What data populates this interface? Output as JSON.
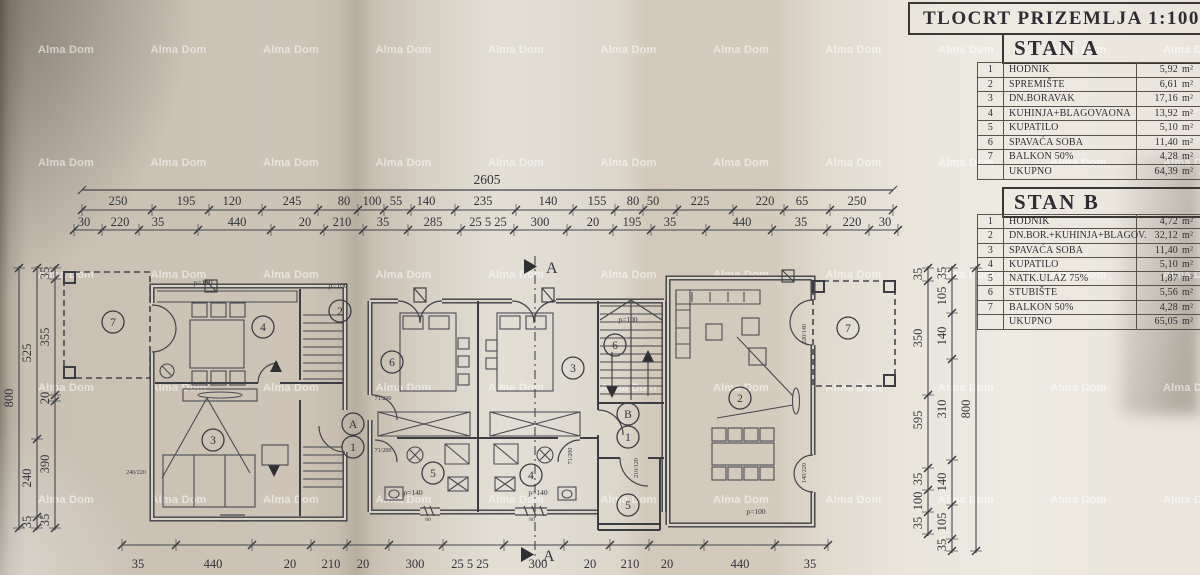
{
  "title_block": {
    "title": "TLOCRT  PRIZEMLJA 1:100"
  },
  "watermark": {
    "text": "Alma Dom"
  },
  "tables": {
    "stanA": {
      "header": "STAN A",
      "unit": "m²",
      "rows": [
        {
          "num": "1",
          "name": "HODNIK",
          "value": "5,92"
        },
        {
          "num": "2",
          "name": "SPREMIŠTE",
          "value": "6,61"
        },
        {
          "num": "3",
          "name": "DN.BORAVAK",
          "value": "17,16"
        },
        {
          "num": "4",
          "name": "KUHINJA+BLAGOVAONA",
          "value": "13,92"
        },
        {
          "num": "5",
          "name": "KUPATILO",
          "value": "5,10"
        },
        {
          "num": "6",
          "name": "SPAVAĆA SOBA",
          "value": "11,40"
        },
        {
          "num": "7",
          "name": "BALKON 50%",
          "value": "4,28"
        }
      ],
      "total": {
        "label": "UKUPNO",
        "value": "64,39"
      }
    },
    "stanB": {
      "header": "STAN B",
      "unit": "m²",
      "rows": [
        {
          "num": "1",
          "name": "HODNIK",
          "value": "4,72"
        },
        {
          "num": "2",
          "name": "DN.BOR.+KUHINJA+BLAGOV.",
          "value": "32,12"
        },
        {
          "num": "3",
          "name": "SPAVAĆA SOBA",
          "value": "11,40"
        },
        {
          "num": "4",
          "name": "KUPATILO",
          "value": "5,10"
        },
        {
          "num": "5",
          "name": "NATK.ULAZ 75%",
          "value": "1,87"
        },
        {
          "num": "6",
          "name": "STUBIŠTE",
          "value": "5,56"
        },
        {
          "num": "7",
          "name": "BALKON 50%",
          "value": "4,28"
        }
      ],
      "total": {
        "label": "UKUPNO",
        "value": "65,05"
      }
    }
  },
  "plan": {
    "section_label": "A",
    "dims": {
      "total": "2605",
      "top_row2": [
        "250",
        "195",
        "120",
        "245",
        "80",
        "100",
        "55",
        "140",
        "235",
        "140",
        "155",
        "80",
        "50",
        "225",
        "220",
        "65",
        "250"
      ],
      "top_row3": [
        "30",
        "220",
        "35",
        "440",
        "20",
        "210",
        "35",
        "285",
        "25 5 25",
        "300",
        "20",
        "195",
        "35",
        "440",
        "35",
        "220",
        "30"
      ],
      "bottom": [
        "35",
        "440",
        "20",
        "210",
        "20",
        "300",
        "25 5 25",
        "300",
        "20",
        "210",
        "20",
        "440",
        "35"
      ],
      "left_cols": [
        [
          "35",
          "355",
          "20",
          "390",
          "35"
        ],
        [
          "525",
          "240",
          "35"
        ],
        [
          "800"
        ]
      ],
      "right_cols": [
        [
          "35",
          "350",
          "595",
          "35",
          "100",
          "35"
        ],
        [
          "35",
          "105",
          "140",
          "310",
          "140",
          "105",
          "35"
        ],
        [
          "800"
        ]
      ]
    },
    "room_circles": [
      "7",
      "4",
      "2",
      "3",
      "A",
      "1",
      "6",
      "3",
      "6",
      "B",
      "1",
      "5",
      "4",
      "5",
      "2",
      "7"
    ],
    "area_labels": [
      "p=100",
      "p=100",
      "p=100",
      "p=140",
      "p=140",
      "p=100"
    ],
    "door_labels": [
      "71/200",
      "71/200",
      "71/200",
      "210/120",
      "220/140",
      "140/220",
      "240/220"
    ],
    "window_labels": [
      "80",
      "80"
    ]
  }
}
